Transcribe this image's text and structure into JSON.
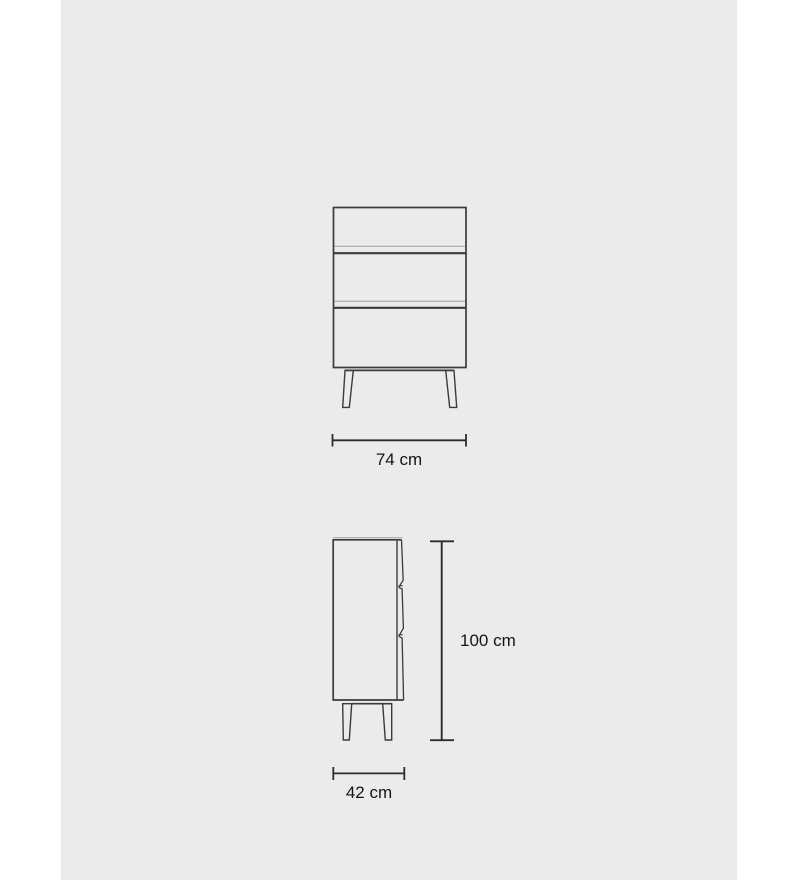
{
  "colors": {
    "page_background": "#ffffff",
    "panel_background": "#ebebeb",
    "line": "#3b3b3b",
    "line_light": "#9f9f9f",
    "dimension_line": "#2c2c2c",
    "text": "#141414"
  },
  "diagram": {
    "drawer_count": 3,
    "dimensions": {
      "width": {
        "label": "74 cm",
        "value_cm": 74
      },
      "height": {
        "label": "100 cm",
        "value_cm": 100
      },
      "depth": {
        "label": "42 cm",
        "value_cm": 42
      }
    }
  }
}
